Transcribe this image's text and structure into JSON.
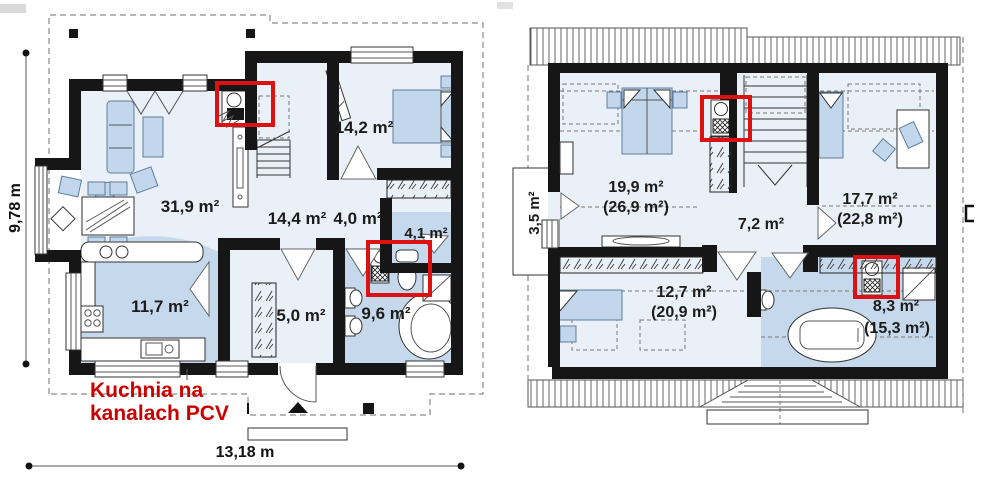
{
  "ground_floor": {
    "name": "ground-floor-plan",
    "rooms": [
      {
        "id": "living-room",
        "area": "31,9 m²"
      },
      {
        "id": "bedroom",
        "area": "14,2 m²"
      },
      {
        "id": "hall",
        "area": "14,4 m²"
      },
      {
        "id": "corridor",
        "area": "4,0 m²"
      },
      {
        "id": "wc",
        "area": "4,1 m²"
      },
      {
        "id": "kitchen",
        "area": "11,7 m²"
      },
      {
        "id": "vestibule",
        "area": "5,0 m²"
      },
      {
        "id": "bathroom",
        "area": "9,6 m²"
      }
    ],
    "dimensions": {
      "width": "13,18 m",
      "height": "9,78 m"
    },
    "annotation": {
      "line1": "Kuchnia na",
      "line2": "kanalach PCV"
    }
  },
  "upper_floor": {
    "name": "upper-floor-plan",
    "rooms": [
      {
        "id": "bedroom-1",
        "area": "19,9 m²",
        "floor_area": "(26,9 m²)"
      },
      {
        "id": "landing",
        "area": "7,2 m²",
        "floor_area": ""
      },
      {
        "id": "bedroom-2",
        "area": "17,7 m²",
        "floor_area": "(22,8 m²)"
      },
      {
        "id": "bedroom-3",
        "area": "12,7 m²",
        "floor_area": "(20,9 m²)"
      },
      {
        "id": "bathroom-up",
        "area": "8,3 m²",
        "floor_area": "(15,3 m²)"
      }
    ],
    "balcony_area": "3,5 m²"
  },
  "colors": {
    "wall": "#161616",
    "floor_light": "#eaf0f8",
    "floor_blue": "#c6d9ec",
    "furniture": "#c2d7ec",
    "highlight_box": "#dd1111",
    "annotation_text": "#cc0000"
  }
}
